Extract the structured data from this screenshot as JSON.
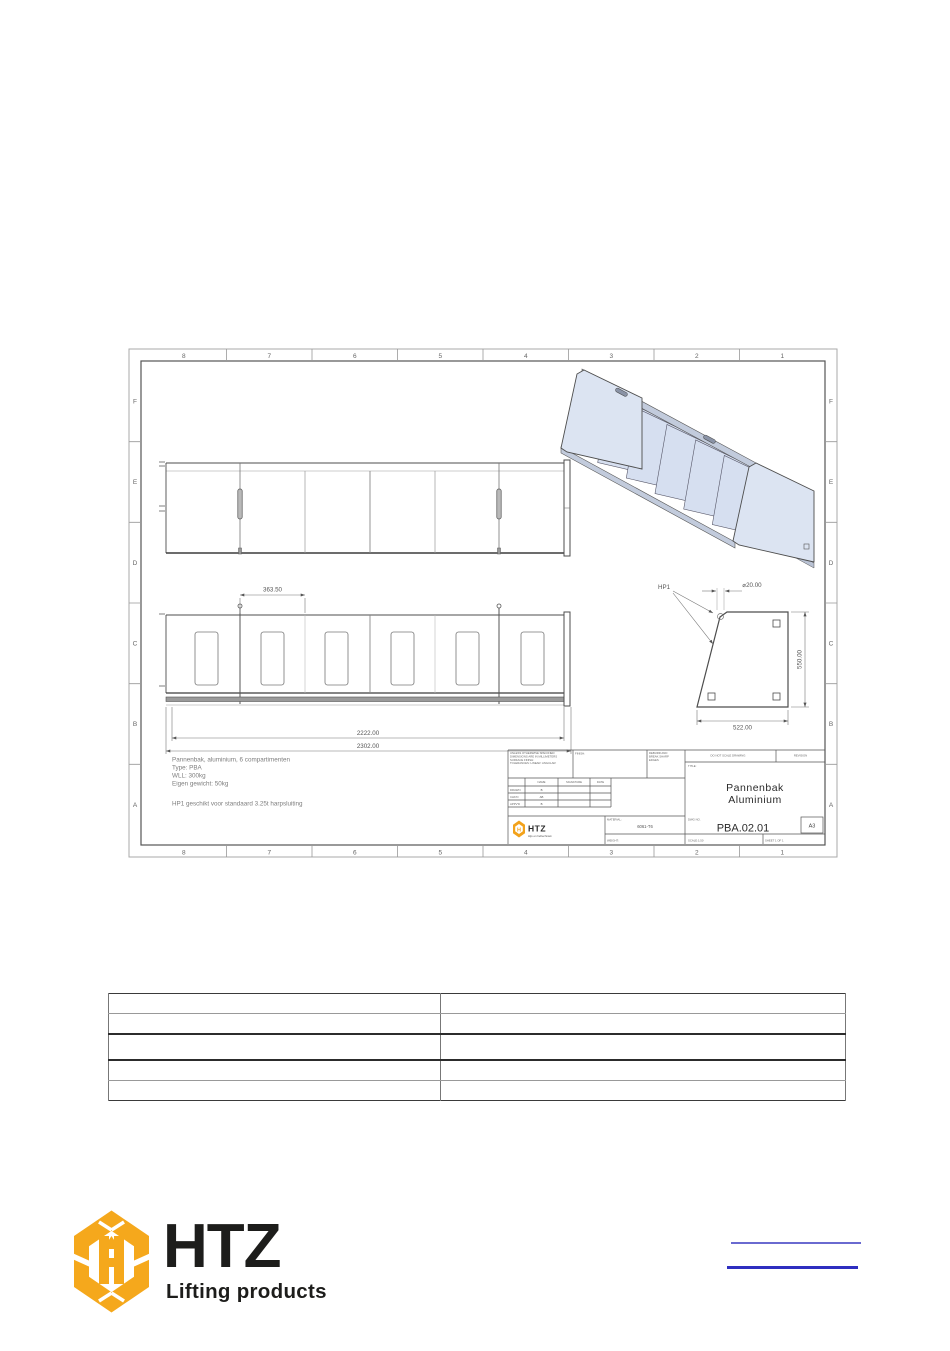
{
  "document": {
    "drawing": {
      "frame": {
        "columns": [
          "8",
          "7",
          "6",
          "5",
          "4",
          "3",
          "2",
          "1"
        ],
        "rows": [
          "F",
          "E",
          "D",
          "C",
          "B",
          "A"
        ]
      },
      "notes": {
        "line1": "Pannenbak, aluminium, 6 compartimenten",
        "line2": "Type: PBA",
        "line3": "WLL: 300kg",
        "line4": "Eigen gewicht: 50kg",
        "line5": "HP1 geschikt voor standaard 3.25t harpsluiting"
      },
      "dimensions": {
        "compartment_pitch": "363.50",
        "inner_length": "2222.00",
        "overall_length": "2302.00",
        "side_width": "522.00",
        "side_height": "550.00",
        "hole_diameter": "⌀20.00",
        "hole_label": "HP1"
      },
      "title_block": {
        "spec_note_l1": "UNLESS OTHERWISE SPECIFIED:",
        "spec_note_l2": "DIMENSIONS ARE IN MILLIMETERS",
        "spec_note_l3": "SURFACE FINISH:",
        "spec_note_l4": "TOLERANCES:  LINEAR:  ANGULAR:",
        "finish_label": "FINISH:",
        "deburr_l1": "DEBURR AND",
        "deburr_l2": "BREAK SHARP",
        "deburr_l3": "EDGES",
        "do_not_scale": "DO NOT SCALE DRAWING",
        "revision_label": "REVISION",
        "title_label": "TITLE:",
        "title_line1": "Pannenbak",
        "title_line2": "Aluminium",
        "col_name": "NAME",
        "col_signature": "SIGNATURE",
        "col_date": "DATE",
        "row_drawn": "DRAWN",
        "row_chkd": "CHK'D",
        "row_appvd": "APPV'D",
        "val_drawn": "B",
        "val_chkd": "AB",
        "val_appvd": "B",
        "material_label": "MATERIAL:",
        "material_value": "6061-T6",
        "weight_label": "WEIGHT:",
        "dwg_label": "DWG NO.",
        "dwg_no": "PBA.02.01",
        "paper_size": "A3",
        "scale_label": "SCALE:1:50",
        "sheet_label": "SHEET 1 OF 1",
        "logo_text": "HTZ",
        "logo_tagline": "Hijs en heftechniek"
      }
    },
    "table": {
      "rows": [
        [
          "",
          ""
        ],
        [
          "",
          ""
        ],
        [
          "",
          ""
        ],
        [
          "",
          ""
        ],
        [
          "",
          ""
        ]
      ]
    },
    "footer": {
      "logo_text": "HTZ",
      "logo_tagline": "Lifting products",
      "brand_yellow": "#F5A81C",
      "brand_dark": "#1D1D1B",
      "link_color_1": "#6A6AD0",
      "link_color_2": "#2E2EC0"
    }
  }
}
